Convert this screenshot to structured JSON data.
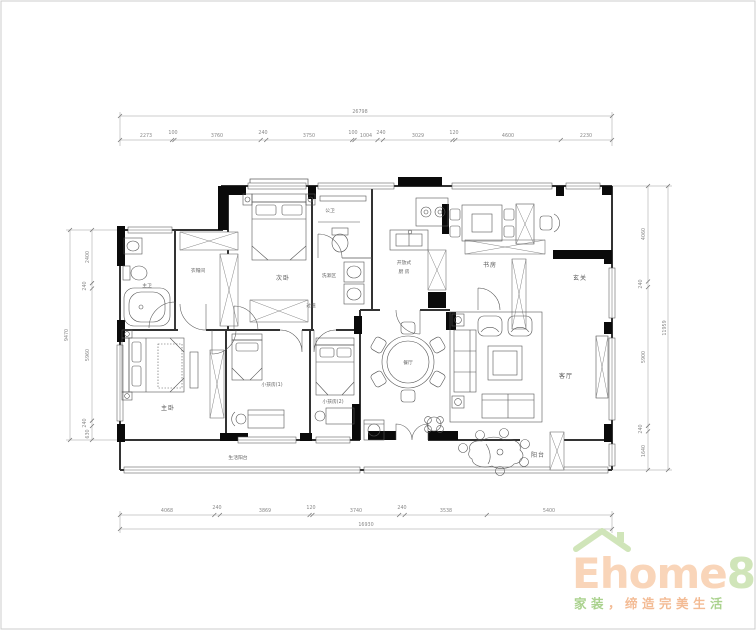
{
  "rooms": {
    "master_bath": "主卫",
    "cloakroom": "衣帽间",
    "bedroom2": "次卧",
    "guest_bath": "公卫",
    "wash_area": "洗漱区",
    "corridor": "过道",
    "kitchen_line1": "开放式",
    "kitchen_line2": "厨 房",
    "study": "书房",
    "entry": "玄关",
    "dining": "餐厅",
    "living": "客厅",
    "leisure_balcony": "阳台",
    "service_balcony": "生活阳台",
    "master_bedroom": "主卧",
    "kids_room1": "小孩房(1)",
    "kids_room2": "小孩房(2)"
  },
  "dims": {
    "top": {
      "total": "26798",
      "segments": [
        "2273",
        "100",
        "3760",
        "240",
        "3750",
        "100",
        "1004",
        "240",
        "3029",
        "120",
        "4600",
        "2230"
      ]
    },
    "bottom": {
      "total": "16930",
      "segments": [
        "4068",
        "240",
        "3869",
        "120",
        "3740",
        "240",
        "3538",
        "5400"
      ]
    },
    "left": {
      "total": "9470",
      "segments": [
        "2400",
        "240",
        "5960",
        "240",
        "630"
      ]
    },
    "right": {
      "total": "11959",
      "segments": [
        "4060",
        "240",
        "5900",
        "240",
        "1640"
      ]
    }
  },
  "watermark": {
    "brand_prefix": "Ehome",
    "brand_suffix": "8",
    "tagline_part1": "家装",
    "tagline_part2": "，缔造完美生",
    "tagline_part3": "活",
    "colors": {
      "roof_green": "#cde3b4",
      "text_peach": "#f9d2b4",
      "eight_green": "#cde3b4",
      "tagline_green": "#a3cf85",
      "tagline_orange": "#f3b68c"
    }
  }
}
